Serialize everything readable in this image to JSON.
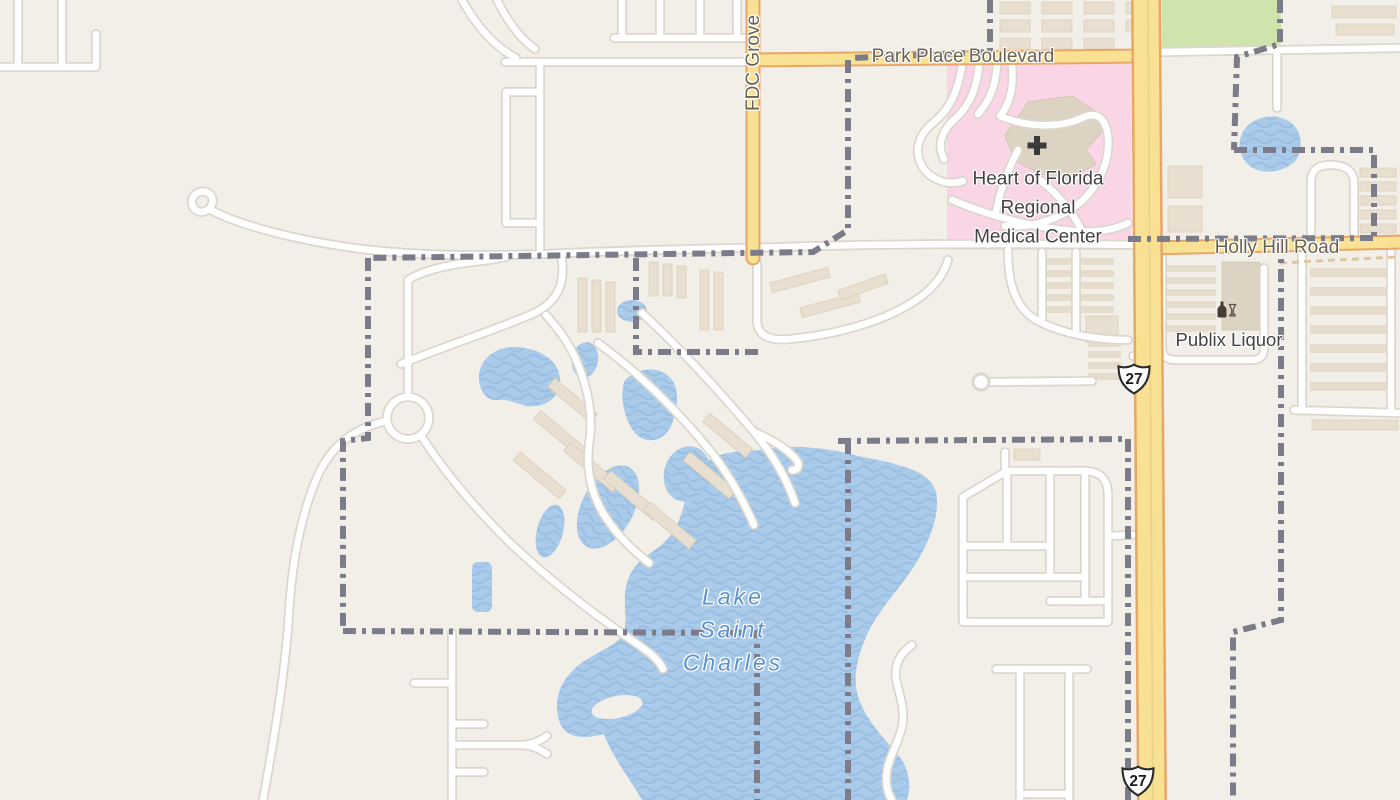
{
  "map": {
    "view": "street-map",
    "labels": {
      "park_place_boulevard": "Park Place Boulevard",
      "fdc_grove": "FDC Grove",
      "hospital": {
        "line1": "Heart of Florida",
        "line2": "Regional",
        "line3": "Medical Center"
      },
      "holly_hill_road": "Holly Hill Road",
      "publix_liquor": "Publix Liquor",
      "lake": {
        "line1": "Lake",
        "line2": "Saint",
        "line3": "Charles"
      }
    },
    "shields": {
      "us27_north": "27",
      "us27_south": "27"
    },
    "icons": {
      "hospital": "hospital-cross-icon",
      "liquor": "liquor-bottle-icon",
      "route_shield": "us-route-shield-icon"
    },
    "colors": {
      "background": "#f2efe8",
      "water": "#aacbe9",
      "water_wave": "#9cc0e3",
      "water_label": "#5d92cf",
      "road_minor": "#ffffff",
      "road_minor_casing": "#dcd7ce",
      "road_primary": "#f8e193",
      "road_primary_casing": "#e8a667",
      "hospital_area": "#fad5e5",
      "park_green": "#cfe3ad",
      "building": "#e9dfd0",
      "boundary": "#7b7b8a",
      "road_label": "#6b6252",
      "poi_label": "#434343"
    }
  }
}
